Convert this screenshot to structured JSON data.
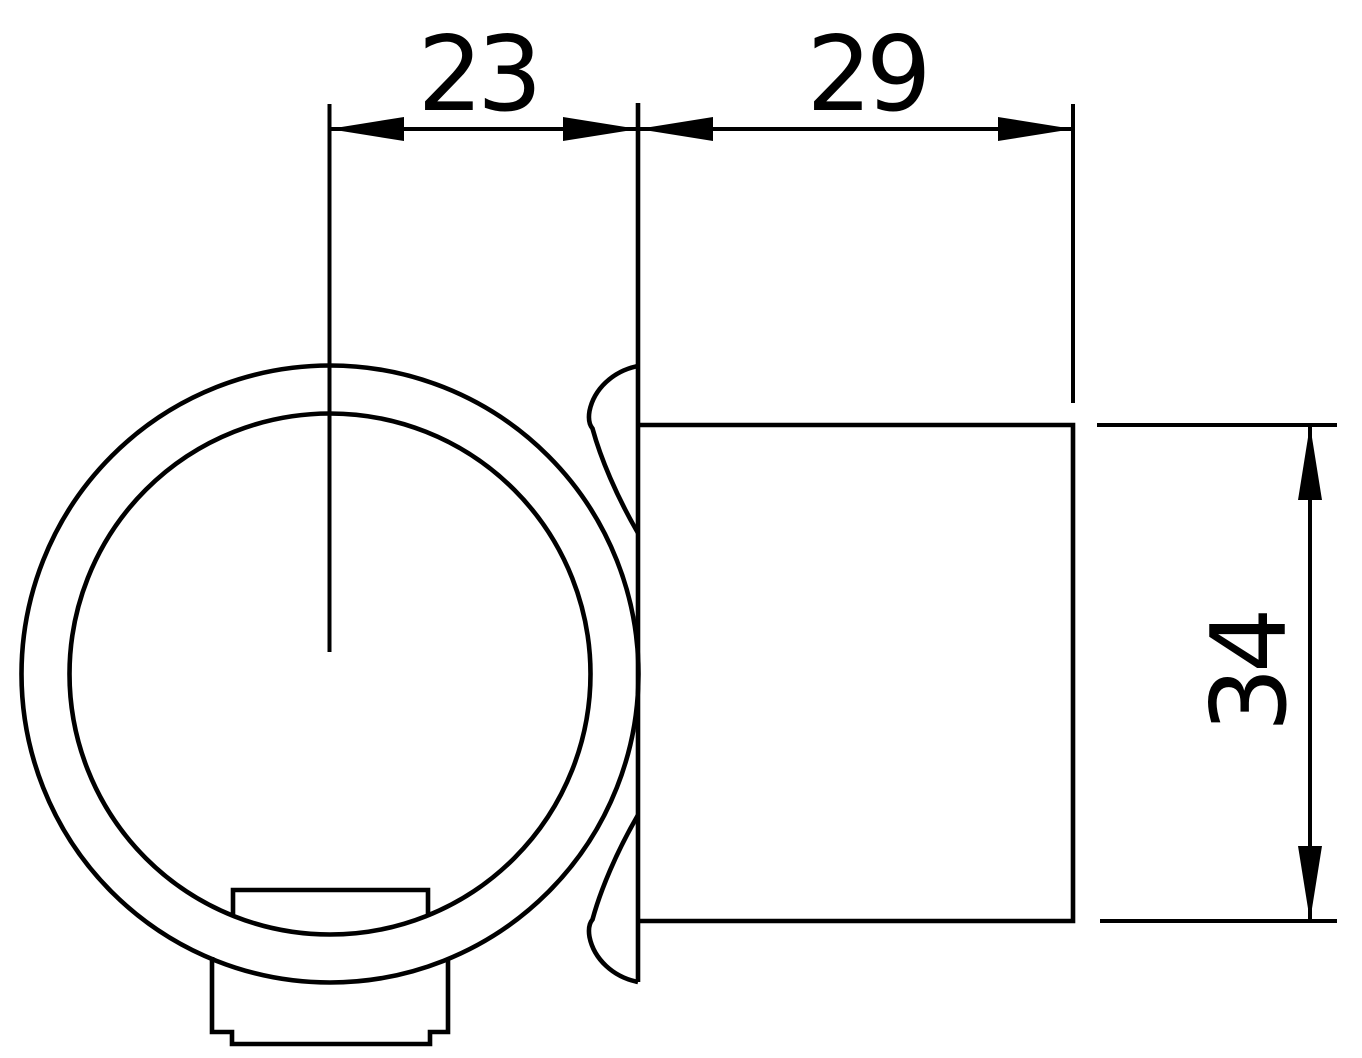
{
  "drawing": {
    "kind": "tube-clamp-fitting-technical-drawing",
    "colors": {
      "line": "#000000",
      "background": "#ffffff"
    },
    "dimensions": {
      "center_to_flange": {
        "value": "23"
      },
      "socket_length": {
        "value": "29"
      },
      "socket_diameter": {
        "value": "34"
      }
    }
  }
}
